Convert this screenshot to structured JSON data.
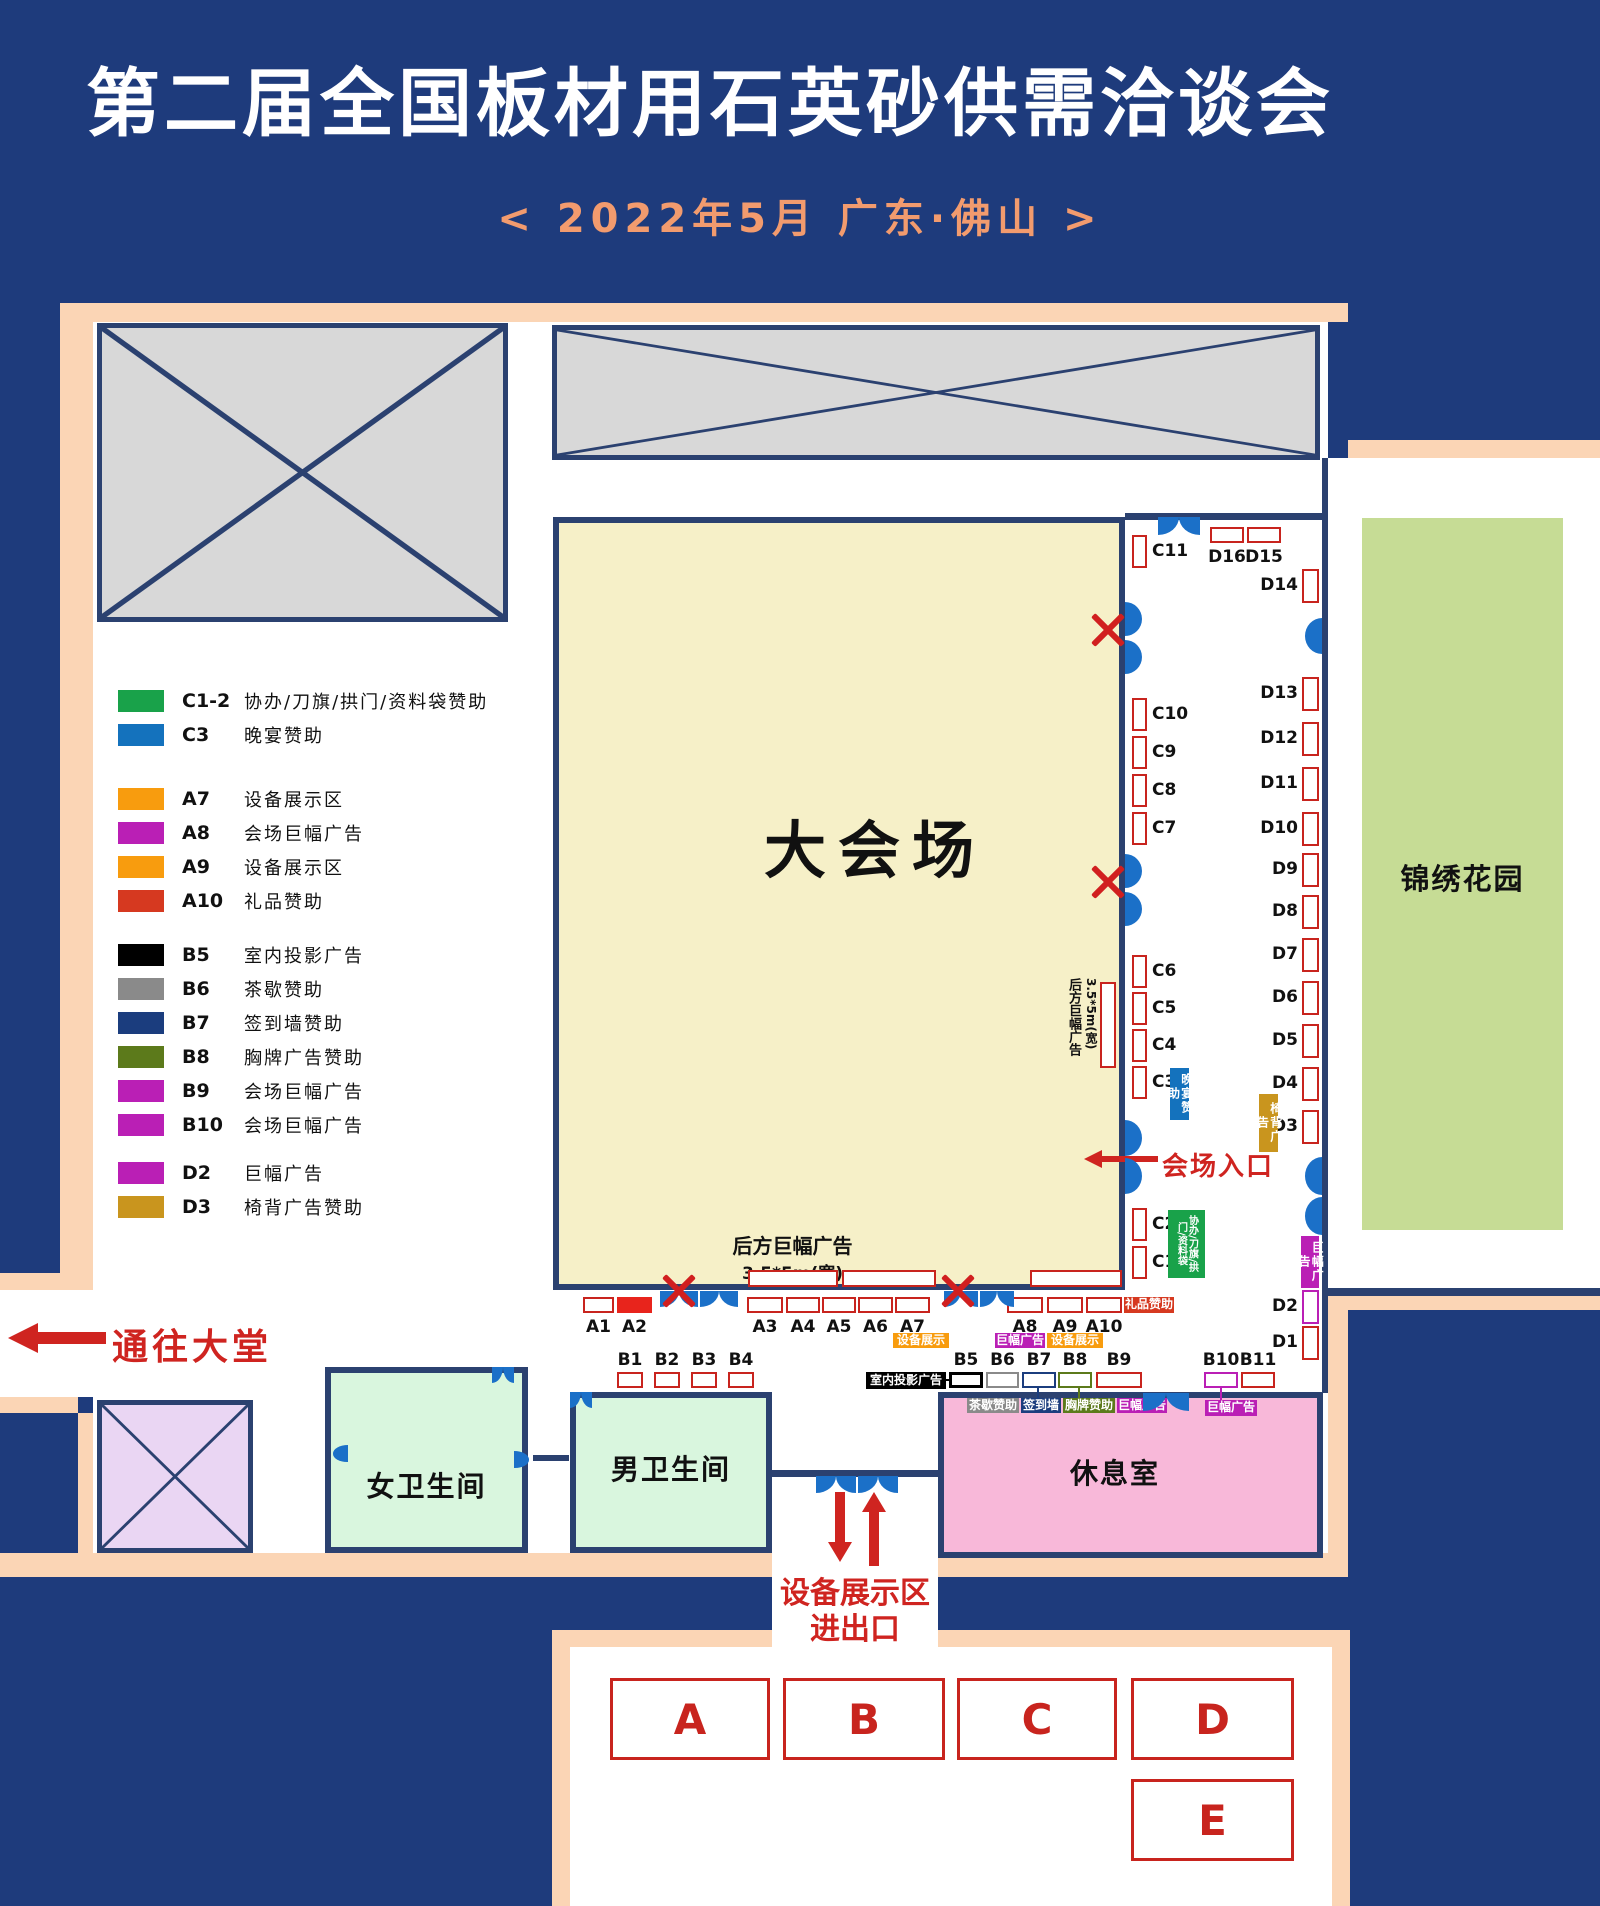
{
  "header": {
    "title": "第二届全国板材用石英砂供需洽谈会",
    "subtitle": "<  2022年5月      广东·佛山  >"
  },
  "colors": {
    "background_navy": "#1e3b7c",
    "wall_navy": "#2b4170",
    "peach_border": "#fbd5b5",
    "hall_yellow": "#f6f0c8",
    "restroom_green": "#d9f6de",
    "lounge_pink": "#f8b8d9",
    "blocked_lavender": "#ead6f3",
    "blocked_gray": "#d8d8d8",
    "garden_green": "#c6dc95",
    "booth_red": "#c8241e",
    "door_blue": "#1b70c8",
    "accent_red": "#cf2420",
    "green": "#19a24a",
    "blue": "#1472bd",
    "orange": "#f89c0e",
    "magenta": "#ba1fb5",
    "red": "#d63920",
    "black": "#000000",
    "gray": "#8a8a8a",
    "navy": "#1b3d7e",
    "olive": "#5c7a1b",
    "gold": "#c9951e"
  },
  "legend": {
    "groups": [
      {
        "rows": [
          {
            "code": "C1-2",
            "color": "#19a24a",
            "desc": "协办/刀旗/拱门/资料袋赞助"
          },
          {
            "code": "C3",
            "color": "#1472bd",
            "desc": "晚宴赞助"
          }
        ]
      },
      {
        "rows": [
          {
            "code": "A7",
            "color": "#f89c0e",
            "desc": "设备展示区"
          },
          {
            "code": "A8",
            "color": "#ba1fb5",
            "desc": "会场巨幅广告"
          },
          {
            "code": "A9",
            "color": "#f89c0e",
            "desc": "设备展示区"
          },
          {
            "code": "A10",
            "color": "#d63920",
            "desc": "礼品赞助"
          }
        ]
      },
      {
        "rows": [
          {
            "code": "B5",
            "color": "#000000",
            "desc": "室内投影广告"
          },
          {
            "code": "B6",
            "color": "#8a8a8a",
            "desc": "茶歇赞助"
          },
          {
            "code": "B7",
            "color": "#1b3d7e",
            "desc": "签到墙赞助"
          },
          {
            "code": "B8",
            "color": "#5c7a1b",
            "desc": "胸牌广告赞助"
          },
          {
            "code": "B9",
            "color": "#ba1fb5",
            "desc": "会场巨幅广告"
          },
          {
            "code": "B10",
            "color": "#ba1fb5",
            "desc": "会场巨幅广告"
          }
        ]
      },
      {
        "rows": [
          {
            "code": "D2",
            "color": "#ba1fb5",
            "desc": "巨幅广告"
          },
          {
            "code": "D3",
            "color": "#c9951e",
            "desc": "椅背广告赞助"
          }
        ]
      }
    ]
  },
  "rooms": {
    "main_hall": "大会场",
    "garden": "锦绣花园",
    "women_restroom": "女卫生间",
    "men_restroom": "男卫生间",
    "lounge": "休息室"
  },
  "annotations": {
    "to_lobby": "通往大堂",
    "hall_entrance": "会场入口",
    "rear_banner_line1": "后方巨幅广告",
    "rear_banner_line2": "3.5*5m(宽)",
    "equipment_gate_line1": "设备展示区",
    "equipment_gate_line2": "进出口"
  },
  "booths": {
    "a_row": [
      "A1",
      "A2",
      "A3",
      "A4",
      "A5",
      "A6",
      "A7",
      "A8",
      "A9",
      "A10"
    ],
    "b_row_left": [
      "B1",
      "B2",
      "B3",
      "B4"
    ],
    "b_row_mid": [
      "B5",
      "B6",
      "B7",
      "B8",
      "B9"
    ],
    "b_row_right": [
      "B10",
      "B11"
    ],
    "c_column": [
      "C11",
      "C10",
      "C9",
      "C8",
      "C7",
      "C6",
      "C5",
      "C4",
      "C3",
      "C2",
      "C1"
    ],
    "d_column": [
      "D14",
      "D13",
      "D12",
      "D11",
      "D10",
      "D9",
      "D8",
      "D7",
      "D6",
      "D5",
      "D4",
      "D3",
      "D2",
      "D1"
    ],
    "d_top": [
      "D16",
      "D15"
    ]
  },
  "tags": [
    {
      "text": "晚宴赞助",
      "color": "#1472bd",
      "vertical": true
    },
    {
      "text": "椅背广告",
      "color": "#c9951e",
      "vertical": true
    },
    {
      "text": "协办/刀旗/拱门/资料袋",
      "color": "#19a24a",
      "vertical": true
    },
    {
      "text": "巨幅广告",
      "color": "#ba1fb5",
      "vertical": true
    },
    {
      "text": "礼品赞助",
      "color": "#d63920",
      "vertical": false
    },
    {
      "text": "设备展示",
      "color": "#f89c0e",
      "vertical": false
    },
    {
      "text": "巨幅广告",
      "color": "#ba1fb5",
      "vertical": false
    },
    {
      "text": "设备展示",
      "color": "#f89c0e",
      "vertical": false
    },
    {
      "text": "室内投影广告",
      "color": "#000000",
      "vertical": false
    },
    {
      "text": "茶歇赞助",
      "color": "#8a8a8a",
      "vertical": false
    },
    {
      "text": "签到墙",
      "color": "#1b3d7e",
      "vertical": false
    },
    {
      "text": "胸牌赞助",
      "color": "#5c7a1b",
      "vertical": false
    },
    {
      "text": "巨幅广告",
      "color": "#ba1fb5",
      "vertical": false
    },
    {
      "text": "巨幅广告",
      "color": "#ba1fb5",
      "vertical": false
    }
  ],
  "equipment_zones": [
    "A",
    "B",
    "C",
    "D",
    "E"
  ]
}
